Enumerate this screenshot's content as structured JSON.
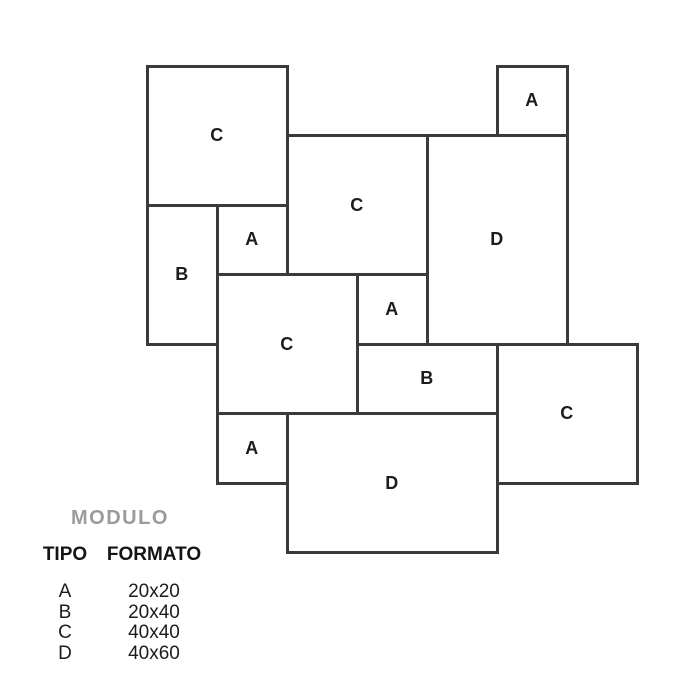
{
  "diagram": {
    "grid": {
      "origin_x": 147,
      "origin_y": 66,
      "cell_w": 70,
      "cell_h": 69.5,
      "line_width": 3
    },
    "line_color": "#3a3a3a",
    "tile_fill": "#ffffff",
    "label_color": "#1c1c1c",
    "tiles": [
      {
        "type": "C",
        "col": 0,
        "row": 0,
        "cols": 2,
        "rows": 2
      },
      {
        "type": "A",
        "col": 5,
        "row": 0,
        "cols": 1,
        "rows": 1
      },
      {
        "type": "C",
        "col": 2,
        "row": 1,
        "cols": 2,
        "rows": 2
      },
      {
        "type": "D",
        "col": 4,
        "row": 1,
        "cols": 2,
        "rows": 3
      },
      {
        "type": "B",
        "col": 0,
        "row": 2,
        "cols": 1,
        "rows": 2
      },
      {
        "type": "A",
        "col": 1,
        "row": 2,
        "cols": 1,
        "rows": 1
      },
      {
        "type": "C",
        "col": 1,
        "row": 3,
        "cols": 2,
        "rows": 2
      },
      {
        "type": "A",
        "col": 3,
        "row": 3,
        "cols": 1,
        "rows": 1
      },
      {
        "type": "B",
        "col": 3,
        "row": 4,
        "cols": 2,
        "rows": 1
      },
      {
        "type": "C",
        "col": 5,
        "row": 4,
        "cols": 2,
        "rows": 2
      },
      {
        "type": "A",
        "col": 1,
        "row": 5,
        "cols": 1,
        "rows": 1
      },
      {
        "type": "D",
        "col": 2,
        "row": 5,
        "cols": 3,
        "rows": 2
      }
    ]
  },
  "legend": {
    "title": "MODULO",
    "title_color": "#9b9b9b",
    "col_headers": [
      "TIPO",
      "FORMATO"
    ],
    "rows": [
      {
        "tipo": "A",
        "formato": "20x20"
      },
      {
        "tipo": "B",
        "formato": "20x40"
      },
      {
        "tipo": "C",
        "formato": "40x40"
      },
      {
        "tipo": "D",
        "formato": "40x60"
      }
    ]
  }
}
